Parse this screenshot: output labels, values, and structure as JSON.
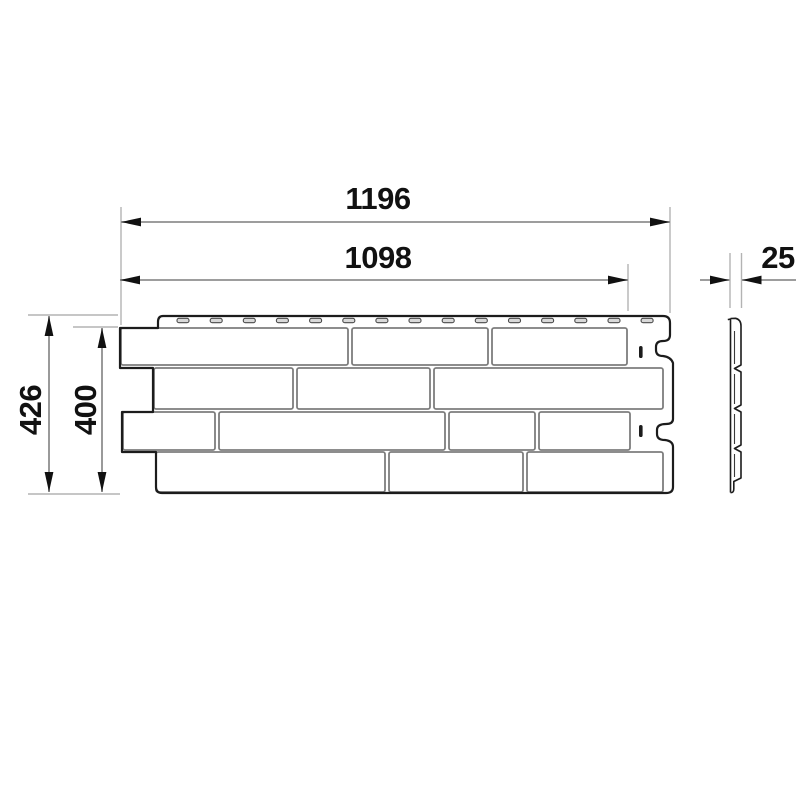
{
  "figure": {
    "type": "technical-dimensional-drawing",
    "subject": "brick-texture facade panel, front view with side profile",
    "background_color": "#ffffff",
    "colors": {
      "outline": "#1c1c1c",
      "brick_seam": "#7d7d7d",
      "dimension_line": "#8f8f8f",
      "extension_line": "#b3b3b3",
      "slot_fill": "#d9d9d9",
      "text": "#111111"
    },
    "dimensions": {
      "total_width": "1196",
      "useful_width": "1098",
      "thickness": "25",
      "total_height": "426",
      "useful_height": "400"
    },
    "features": {
      "nail_slot_count": 15,
      "brick_row_count": 4,
      "bricks_per_row": [
        3,
        3,
        4,
        3
      ],
      "edge_tick_count": 2
    }
  }
}
